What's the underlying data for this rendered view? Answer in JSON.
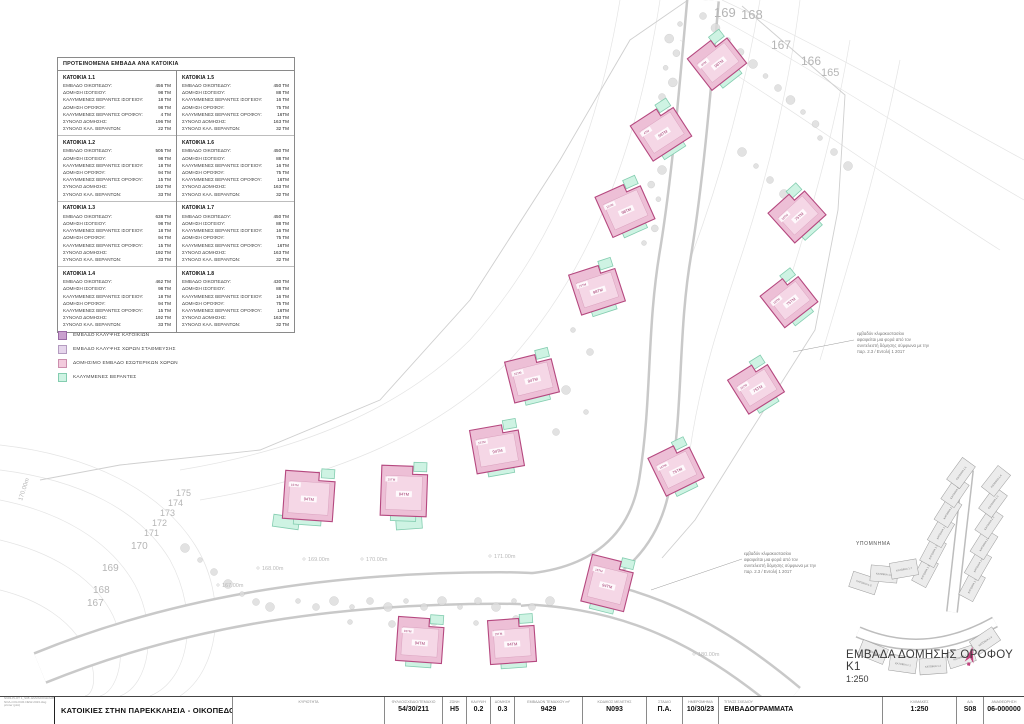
{
  "table": {
    "title": "ΠΡΟΤΕΙΝΟΜΕΝΑ ΕΜΒΑΔΑ ΑΝΑ ΚΑΤΟΙΚΙΑ",
    "row_labels": [
      "ΕΜΒΑΔΟ ΟΙΚΟΠΕΔΟΥ:",
      "ΔΟΜΗΣΗ ΙΣΟΓΕΙΟΥ:",
      "ΚΑΛΥΜΜΕΝΕΣ ΒΕΡΑΝΤΕΣ ΙΣΟΓΕΙΟΥ:",
      "ΔΟΜΗΣΗ ΟΡΟΦΟΥ:",
      "ΚΑΛΥΜΜΕΝΕΣ ΒΕΡΑΝΤΕΣ ΟΡΟΦΟΥ:",
      "ΣΥΝΟΛΟ ΔΟΜΗΣΗΣ:",
      "ΣΥΝΟΛΟ ΚΑΛ. ΒΕΡΑΝΤΩΝ:"
    ],
    "blocks": [
      {
        "name": "ΚΑΤΟΙΚΙΑ 1.1",
        "values": [
          "456 ΤΜ",
          "98 ΤΜ",
          "18 ΤΜ",
          "98 ΤΜ",
          "4 ΤΜ",
          "196 ΤΜ",
          "22 ΤΜ"
        ]
      },
      {
        "name": "ΚΑΤΟΙΚΙΑ 1.2",
        "values": [
          "505 ΤΜ",
          "98 ΤΜ",
          "18 ΤΜ",
          "94 ΤΜ",
          "15 ΤΜ",
          "192 ΤΜ",
          "33 ΤΜ"
        ]
      },
      {
        "name": "ΚΑΤΟΙΚΙΑ 1.3",
        "values": [
          "638 ΤΜ",
          "98 ΤΜ",
          "18 ΤΜ",
          "94 ΤΜ",
          "15 ΤΜ",
          "192 ΤΜ",
          "33 ΤΜ"
        ]
      },
      {
        "name": "ΚΑΤΟΙΚΙΑ 1.4",
        "values": [
          "462 ΤΜ",
          "98 ΤΜ",
          "18 ΤΜ",
          "94 ΤΜ",
          "15 ΤΜ",
          "192 ΤΜ",
          "33 ΤΜ"
        ]
      },
      {
        "name": "ΚΑΤΟΙΚΙΑ 1.5",
        "values": [
          "450 ΤΜ",
          "88 ΤΜ",
          "16 ΤΜ",
          "75 ΤΜ",
          "16ΤΜ",
          "163 ΤΜ",
          "32 ΤΜ"
        ]
      },
      {
        "name": "ΚΑΤΟΙΚΙΑ 1.6",
        "values": [
          "450 ΤΜ",
          "88 ΤΜ",
          "16 ΤΜ",
          "75 ΤΜ",
          "16ΤΜ",
          "163 ΤΜ",
          "32 ΤΜ"
        ]
      },
      {
        "name": "ΚΑΤΟΙΚΙΑ 1.7",
        "values": [
          "450 ΤΜ",
          "88 ΤΜ",
          "16 ΤΜ",
          "75 ΤΜ",
          "16ΤΜ",
          "163 ΤΜ",
          "32 ΤΜ"
        ]
      },
      {
        "name": "ΚΑΤΟΙΚΙΑ 1.8",
        "values": [
          "430 ΤΜ",
          "88 ΤΜ",
          "16 ΤΜ",
          "75 ΤΜ",
          "16ΤΜ",
          "163 ΤΜ",
          "32 ΤΜ"
        ]
      }
    ]
  },
  "legend": {
    "items": [
      {
        "label": "ΕΜΒΑΔΟ ΚΑΛΥΨΗΣ ΚΑΤΟΙΚΙΩΝ",
        "fill": "#c9a0ce",
        "border": "#9a6aa5"
      },
      {
        "label": "ΕΜΒΑΔΟ ΚΑΛΥΨΗΣ ΧΩΡΩΝ ΣΤΑΘΜΕΥΣΗΣ",
        "fill": "#e6d6ec",
        "border": "#b49cc0"
      },
      {
        "label": "ΔΟΜΗΣΙΜΟ ΕΜΒΑΔΟ ΕΣΩΤΕΡΙΚΩΝ ΧΩΡΩΝ",
        "fill": "#f3cbdd",
        "border": "#cc8fae"
      },
      {
        "label": "ΚΑΛΥΜΜΕΝΕΣ ΒΕΡΑΝΤΕΣ",
        "fill": "#cef3e3",
        "border": "#84cdb0"
      }
    ]
  },
  "annotation": {
    "lines": [
      "εμβαδόν κλιμακοστασίου",
      "αφαιρείται μια φορά από τον",
      "συντελεστή δόμησης σύμφωνα με την",
      "παρ. 2.3 / Εντολή 1 2017"
    ]
  },
  "plan": {
    "title": "ΕΜΒΑΔΑ ΔΟΜΗΣΗΣ ΟΡΟΦΟΥ Κ1",
    "scale": "1:250",
    "keymap_label": "ΥΠΟΜΝΗΜΑ",
    "colors": {
      "house_fill": "#edbfd6",
      "house_stroke": "#b5487f",
      "interior_fill": "#f5d7e6",
      "veranda_fill": "#cef3e3",
      "veranda_stroke": "#84cdb0",
      "north_arrow": "#c2417d"
    },
    "houses": [
      {
        "x": 717,
        "y": 61,
        "r": -38,
        "w": 44,
        "h": 40,
        "label": "98ΤΜ",
        "sub": "4ΤΜ"
      },
      {
        "x": 661,
        "y": 131,
        "r": -33,
        "w": 46,
        "h": 42,
        "label": "98ΤΜ",
        "sub": "4ΤΜ"
      },
      {
        "x": 625,
        "y": 208,
        "r": -24,
        "w": 46,
        "h": 44,
        "label": "98ΤΜ",
        "sub": "15ΤΜ"
      },
      {
        "x": 797,
        "y": 214,
        "r": -42,
        "w": 42,
        "h": 40,
        "label": "75ΤΜ",
        "sub": "16ΤΜ"
      },
      {
        "x": 597,
        "y": 288,
        "r": -18,
        "w": 46,
        "h": 42,
        "label": "98ΤΜ",
        "sub": "15ΤΜ"
      },
      {
        "x": 789,
        "y": 299,
        "r": -38,
        "w": 42,
        "h": 40,
        "label": "75ΤΜ",
        "sub": "16ΤΜ"
      },
      {
        "x": 532,
        "y": 377,
        "r": -14,
        "w": 46,
        "h": 42,
        "label": "94ΤΜ",
        "sub": "15ΤΜ"
      },
      {
        "x": 756,
        "y": 386,
        "r": -32,
        "w": 42,
        "h": 40,
        "label": "75ΤΜ",
        "sub": "16ΤΜ"
      },
      {
        "x": 497,
        "y": 448,
        "r": -10,
        "w": 48,
        "h": 44,
        "label": "94ΤΜ",
        "sub": "15ΤΜ"
      },
      {
        "x": 676,
        "y": 468,
        "r": -26,
        "w": 42,
        "h": 42,
        "label": "75ΤΜ",
        "sub": "16ΤΜ"
      },
      {
        "x": 309,
        "y": 496,
        "r": 4,
        "w": 50,
        "h": 48,
        "label": "94ΤΜ",
        "sub": "15ΤΜ"
      },
      {
        "x": 404,
        "y": 491,
        "r": 2,
        "w": 46,
        "h": 50,
        "label": "94ΤΜ",
        "sub": "15ΤΜ"
      },
      {
        "x": 608,
        "y": 583,
        "r": 14,
        "w": 44,
        "h": 48,
        "label": "94ΤΜ",
        "sub": "16ΤΜ"
      },
      {
        "x": 420,
        "y": 640,
        "r": 4,
        "w": 46,
        "h": 44,
        "label": "94ΤΜ",
        "sub": "15ΤΜ"
      },
      {
        "x": 512,
        "y": 641,
        "r": -4,
        "w": 46,
        "h": 44,
        "label": "94ΤΜ",
        "sub": "15ΤΜ"
      }
    ],
    "parking": [
      {
        "x": 286,
        "y": 522,
        "r": 8,
        "w": 26,
        "h": 12
      },
      {
        "x": 409,
        "y": 523,
        "r": -4,
        "w": 26,
        "h": 12
      }
    ],
    "contour_labels": [
      {
        "t": "169",
        "x": 714,
        "y": 4,
        "s": 13
      },
      {
        "t": "168",
        "x": 741,
        "y": 6,
        "s": 13
      },
      {
        "t": "167",
        "x": 771,
        "y": 37,
        "s": 12
      },
      {
        "t": "166",
        "x": 801,
        "y": 53,
        "s": 12
      },
      {
        "t": "165",
        "x": 821,
        "y": 65,
        "s": 11
      },
      {
        "t": "175",
        "x": 176,
        "y": 487,
        "s": 9
      },
      {
        "t": "174",
        "x": 168,
        "y": 497,
        "s": 9
      },
      {
        "t": "173",
        "x": 160,
        "y": 507,
        "s": 9
      },
      {
        "t": "172",
        "x": 152,
        "y": 517,
        "s": 9
      },
      {
        "t": "171",
        "x": 144,
        "y": 527,
        "s": 9
      },
      {
        "t": "170",
        "x": 131,
        "y": 539,
        "s": 10
      },
      {
        "t": "169",
        "x": 102,
        "y": 561,
        "s": 10
      },
      {
        "t": "168",
        "x": 93,
        "y": 583,
        "s": 10
      },
      {
        "t": "167",
        "x": 87,
        "y": 596,
        "s": 10
      },
      {
        "t": "170.00m",
        "x": 22,
        "y": 495,
        "s": 6,
        "r": -72
      }
    ],
    "spot_levels": [
      {
        "t": "167.00m",
        "x": 222,
        "y": 587
      },
      {
        "t": "168.00m",
        "x": 262,
        "y": 570
      },
      {
        "t": "169.00m",
        "x": 308,
        "y": 561
      },
      {
        "t": "170.00m",
        "x": 366,
        "y": 561
      },
      {
        "t": "171.00m",
        "x": 494,
        "y": 558
      },
      {
        "t": "180.00m",
        "x": 698,
        "y": 656
      }
    ],
    "keymap_lots": [
      {
        "x": 925,
        "y": 572,
        "r": -62
      },
      {
        "x": 933,
        "y": 552,
        "r": -62
      },
      {
        "x": 941,
        "y": 532,
        "r": -60
      },
      {
        "x": 948,
        "y": 512,
        "r": -58
      },
      {
        "x": 955,
        "y": 492,
        "r": -56
      },
      {
        "x": 961,
        "y": 473,
        "r": -54
      },
      {
        "x": 972,
        "y": 586,
        "r": -62
      },
      {
        "x": 978,
        "y": 565,
        "r": -60
      },
      {
        "x": 984,
        "y": 544,
        "r": -58
      },
      {
        "x": 989,
        "y": 523,
        "r": -56
      },
      {
        "x": 993,
        "y": 502,
        "r": -54
      },
      {
        "x": 996,
        "y": 481,
        "r": -52
      },
      {
        "x": 864,
        "y": 583,
        "r": 18
      },
      {
        "x": 884,
        "y": 574,
        "r": 5
      },
      {
        "x": 904,
        "y": 569,
        "r": -10
      },
      {
        "x": 873,
        "y": 652,
        "r": 22
      },
      {
        "x": 903,
        "y": 664,
        "r": 8
      },
      {
        "x": 933,
        "y": 666,
        "r": -4
      },
      {
        "x": 961,
        "y": 657,
        "r": -18
      },
      {
        "x": 985,
        "y": 641,
        "r": -34
      }
    ]
  },
  "titleblock": {
    "stamp_lines": [
      "N993-PLOT 1_S08 -EMVADOGRAMMATA",
      "NOA-COLOUR-NEW-2023.dwg",
      "printer (plot)"
    ],
    "project_title": "ΚΑΤΟΙΚΙΕΣ ΣΤΗΝ ΠΑΡΕΚΚΛΗΣΙΑ - ΟΙΚΟΠΕΔΟ 1",
    "fields": [
      {
        "label": "ΚΥΡΙΟΤΗΤΑ",
        "value": ""
      },
      {
        "label": "ΦΥΛΛΟ/ΣΧΕΔΙΟ/ΤΕΜΑΧΙΟ",
        "value": "54/30/211"
      },
      {
        "label": "ΖΩΝΗ",
        "value": "Η5"
      },
      {
        "label": "ΚΑΛΥΨΗ",
        "value": "0.2"
      },
      {
        "label": "ΔΟΜΗΣΗ",
        "value": "0.3"
      },
      {
        "label": "ΕΜΒΑΔΟΝ ΤΕΜΑΧΙΟΥ m²",
        "value": "9429"
      },
      {
        "label": "ΚΩΔΙΚΟΣ ΜΕΛΕΤΗΣ",
        "value": "Ν093"
      },
      {
        "label": "ΣΤΑΔΙΟ",
        "value": "Π.Α."
      },
      {
        "label": "ΗΜΕΡΟΜΗΝΙΑ",
        "value": "10/30/23"
      },
      {
        "label": "ΤΙΤΛΟΣ ΣΧΕΔΙΟΥ",
        "value": "ΕΜΒΑΔΟΓΡΑΜΜΑΤΑ"
      },
      {
        "label": "ΚΛΙΜΑΚΕΣ",
        "value": "1:250"
      },
      {
        "label": "Α/Α",
        "value": "S08"
      },
      {
        "label": "ΑΝΑΘΕΩΡΗΣΗ",
        "value": "06-000000"
      }
    ]
  }
}
